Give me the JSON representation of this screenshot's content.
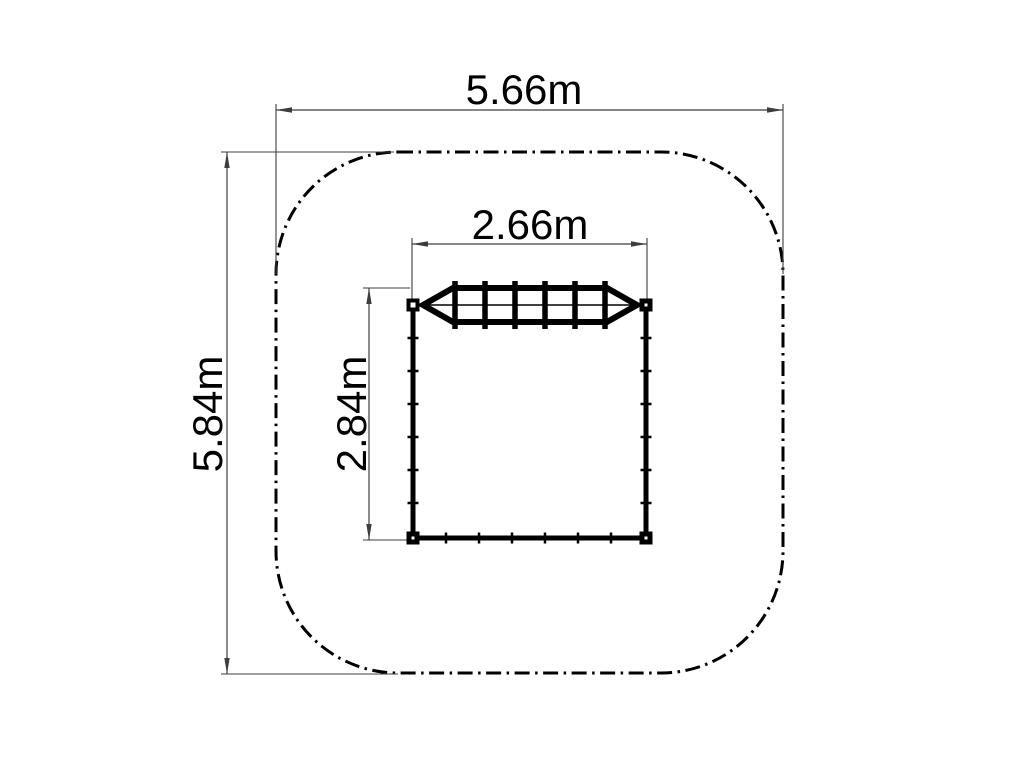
{
  "drawing": {
    "description": "plan-view technical drawing of playground climbing net with safety area",
    "background": "#ffffff",
    "ink_color": "#000000",
    "dim_color": "#3d3d3d",
    "safety_area": {
      "shape": "rounded-square",
      "x": 276,
      "y": 152,
      "width": 507,
      "height": 521,
      "corner_radius": 122,
      "stroke_width": 3,
      "dash_pattern": "15 5.5 2.5 5.5"
    },
    "dimensions": [
      {
        "name": "overall-width",
        "label": "5.66m",
        "line": {
          "x1": 276,
          "y1": 110,
          "x2": 783,
          "y2": 110
        },
        "extensions": [
          {
            "x1": 276,
            "y1": 104,
            "x2": 276,
            "y2": 274
          },
          {
            "x1": 783,
            "y1": 104,
            "x2": 783,
            "y2": 274
          }
        ],
        "label_pos": {
          "x": 524,
          "y": 90,
          "rotate": 0
        }
      },
      {
        "name": "overall-depth",
        "label": "5.84m",
        "line": {
          "x1": 227,
          "y1": 152,
          "x2": 227,
          "y2": 674
        },
        "extensions": [
          {
            "x1": 221,
            "y1": 152,
            "x2": 394,
            "y2": 152
          },
          {
            "x1": 221,
            "y1": 674,
            "x2": 398,
            "y2": 674
          }
        ],
        "label_pos": {
          "x": 208,
          "y": 414,
          "rotate": -90
        }
      },
      {
        "name": "equipment-width",
        "label": "2.66m",
        "line": {
          "x1": 412,
          "y1": 244,
          "x2": 647,
          "y2": 244
        },
        "extensions": [
          {
            "x1": 412,
            "y1": 238,
            "x2": 412,
            "y2": 300
          },
          {
            "x1": 647,
            "y1": 238,
            "x2": 647,
            "y2": 300
          }
        ],
        "label_pos": {
          "x": 530,
          "y": 225,
          "rotate": 0
        }
      },
      {
        "name": "equipment-depth",
        "label": "2.84m",
        "line": {
          "x1": 369,
          "y1": 288,
          "x2": 369,
          "y2": 540
        },
        "extensions": [
          {
            "x1": 363,
            "y1": 288,
            "x2": 410,
            "y2": 288
          },
          {
            "x1": 363,
            "y1": 540,
            "x2": 407,
            "y2": 540
          }
        ],
        "label_pos": {
          "x": 352,
          "y": 414,
          "rotate": -90
        }
      }
    ],
    "arrow": {
      "length": 16,
      "half_width": 2.7
    },
    "equipment": {
      "walls": [
        {
          "name": "left-wall",
          "x1": 413,
          "y1": 305,
          "x2": 413,
          "y2": 540,
          "w": 5
        },
        {
          "name": "right-wall",
          "x1": 646,
          "y1": 305,
          "x2": 646,
          "y2": 540,
          "w": 5
        },
        {
          "name": "bottom-wall",
          "x1": 410.5,
          "y1": 538,
          "x2": 648.5,
          "y2": 538,
          "w": 5
        }
      ],
      "wall_ticks": [
        {
          "name": "left-wall-ticks",
          "orient": "h",
          "x": 413,
          "positions": [
            338,
            371,
            404,
            437,
            470,
            503
          ],
          "len": 11,
          "thick": 2.5
        },
        {
          "name": "right-wall-ticks",
          "orient": "h",
          "x": 646,
          "positions": [
            338,
            371,
            404,
            437,
            470,
            503
          ],
          "len": 11,
          "thick": 2.5
        },
        {
          "name": "bottom-wall-ticks",
          "orient": "v",
          "y": 538,
          "positions": [
            446,
            479,
            512,
            545,
            578,
            611
          ],
          "len": 11,
          "thick": 2.5
        }
      ],
      "posts": [
        {
          "name": "post-top-left",
          "cx": 413,
          "cy": 305,
          "size": 13,
          "hole": 5
        },
        {
          "name": "post-top-right",
          "cx": 646,
          "cy": 305,
          "size": 13,
          "hole": 3
        },
        {
          "name": "post-bottom-left",
          "cx": 413,
          "cy": 538,
          "size": 13,
          "hole": 3
        },
        {
          "name": "post-bottom-right",
          "cx": 646,
          "cy": 538,
          "size": 13,
          "hole": 3
        }
      ],
      "net": {
        "center_line": {
          "x1": 419,
          "y1": 305,
          "x2": 640,
          "y2": 305,
          "w": 1.6
        },
        "frame_points": "423,305 453,288 607,288 637,305 607,322 453,322",
        "frame_stroke": 6,
        "rungs": {
          "xs": [
            455,
            485,
            515,
            545,
            575,
            605
          ],
          "y1": 281,
          "y2": 329,
          "w": 5.5
        }
      }
    }
  }
}
